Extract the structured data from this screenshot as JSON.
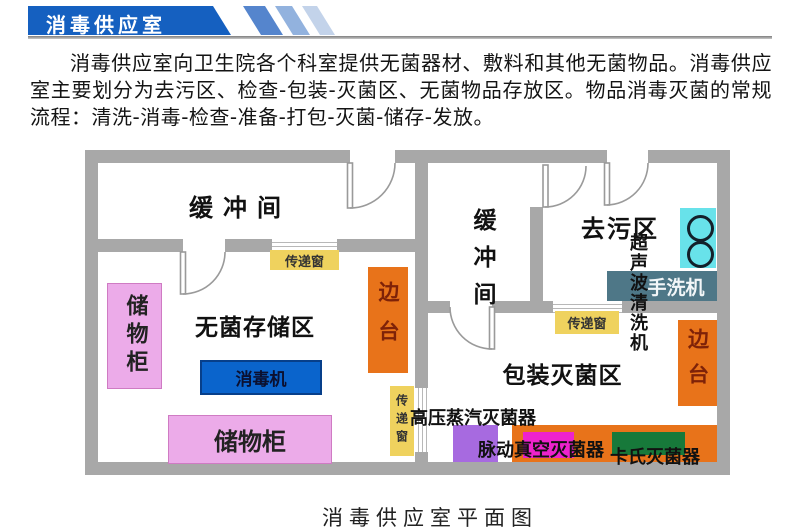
{
  "header": {
    "title": "消毒供应室"
  },
  "intro": "消毒供应室向卫生院各个科室提供无菌器材、敷料和其他无菌物品。消毒供应室主要划分为去污区、检查-包装-灭菌区、无菌物品存放区。物品消毒灭菌的常规流程：清洗-消毒-检查-准备-打包-灭菌-储存-发放。",
  "caption": "消毒供应室平面图",
  "rooms": {
    "buffer_left": "缓冲间",
    "buffer_mid": "缓冲间",
    "decontamination": "去污区",
    "sterile_storage": "无菌存储区",
    "packaging_sterilization": "包装灭菌区"
  },
  "equipment": {
    "storage_cabinet_vertical": "储物柜",
    "storage_cabinet_horizontal": "储物柜",
    "disinfector": "消毒机",
    "side_table_left": "边台",
    "side_table_right": "边台",
    "transfer_window_left": "传递窗",
    "transfer_window_mid": "传递窗",
    "transfer_window_right": "传递窗",
    "ultrasonic_cleaner": "超声波清洗机",
    "hand_washer": "手洗机",
    "steam_sterilizer": "高压蒸汽灭菌器",
    "pulse_vacuum_sterilizer": "脉动真空灭菌器",
    "cassette_sterilizer": "卡氏灭菌器"
  },
  "colors": {
    "banner_blue": "#1560c0",
    "stripe_blue_1": "#5585cd",
    "stripe_blue_2": "#92b2de",
    "stripe_blue_3": "#c3d3ea",
    "wall_gray": "#a8a8a8",
    "cabinet_pink": "#ecabe9",
    "disinfector_blue": "#0a64cc",
    "table_orange": "#e8731a",
    "window_yellow": "#efd25e",
    "sink_cyan": "#68e2ea",
    "washer_slate": "#4e7787",
    "sterilizer_purple": "#a76ae0",
    "sterilizer_magenta": "#ee22cc",
    "sterilizer_green": "#17793a"
  }
}
